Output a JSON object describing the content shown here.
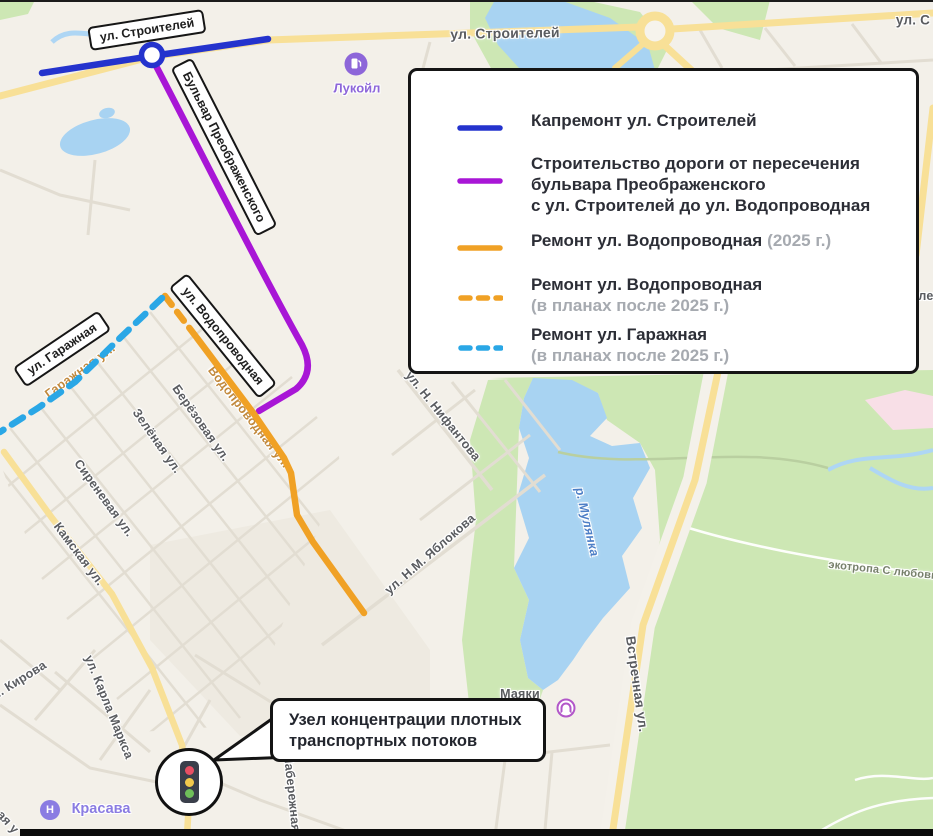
{
  "colors": {
    "route_blue": "#2433cd",
    "route_purple": "#a816d6",
    "route_orange": "#f0a125",
    "route_lightblue": "#2aa7e6"
  },
  "legend": {
    "items": [
      {
        "label": "Капремонт ул. Строителей"
      },
      {
        "line1": "Строительство дороги от пересечения",
        "line2": "бульвара Преображенского",
        "line3": "с ул. Строителей до ул. Водопроводная"
      },
      {
        "label": "Ремонт ул. Водопроводная",
        "note": "(2025 г.)"
      },
      {
        "label": "Ремонт ул. Водопроводная",
        "note": "(в планах после 2025 г.)"
      },
      {
        "label": "Ремонт ул. Гаражная",
        "note": "(в планах после 2025 г.)"
      }
    ]
  },
  "street_boxes": {
    "stroiteley": "ул. Строителей",
    "preobrazhenskogo": "Бульвар Преображенского",
    "garazhnaya": "ул. Гаражная",
    "vodoprovodnaya": "ул. Водопроводная"
  },
  "callout": {
    "line1": "Узел концентрации плотных",
    "line2": "транспортных потоков"
  },
  "map_labels": {
    "stroiteley_top": "ул. Строителей",
    "stroiteley_edge": "ул. С",
    "berezovaya": "Берёзовая ул.",
    "zelenaya": "Зелёная ул.",
    "sirenevaya": "Сиреневая ул.",
    "kamskaya": "Камская ул.",
    "kirova": "ул. Кирова",
    "karla_marksa": "ул. Карла Маркса",
    "yablokova": "ул. Н.М. Яблокова",
    "nifantova": "ул. Н. Нифантова",
    "vstrechnaya": "Встречная ул.",
    "naberezhnaya": "Набережная",
    "mulyanka": "р. Мулянка",
    "ecotrail": "экотропа С любовью",
    "garazhnaya_map": "Гаражная ул.",
    "vodoprovodnaya_map": "Водопроводная ул.",
    "mayaki": "Маяки",
    "edge_right_partial": "ле",
    "edge_bottom_partial": "ая у"
  },
  "pois": {
    "lukoil": "Лукойл",
    "krasava": "Красава",
    "krasava_icon_letter": "Н"
  }
}
